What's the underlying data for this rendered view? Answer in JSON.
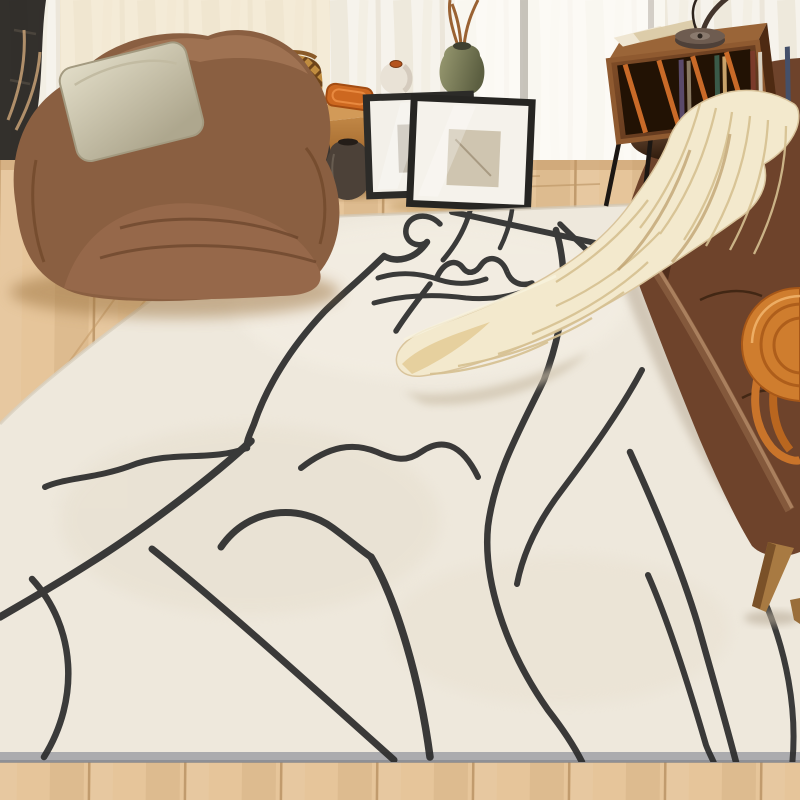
{
  "scene": {
    "kind": "living-room product photo",
    "description": "Bright living room with a large cream area rug decorated with black abstract one-line face art. A brown leather bean-bag armchair with a linen pillow sits at the left by sheer curtains, a wooden bench with baskets, vases and leaning picture frames lines the window, a walnut record cabinet with a black lamp stands beside a brown leather sofa on the right, and a chunky cream knit throw cascades from the sofa armrest onto the rug. An orange woven bag rests on the sofa seat.",
    "objects": [
      "sheer white curtains",
      "black plant stand",
      "light oak plank floor",
      "wooden window bench",
      "rattan lattice basket",
      "orange woven tray",
      "white speckled vase",
      "green ceramic vase with dried branches",
      "two black clay pots",
      "two leaning black picture frames",
      "cream abstract line-art area rug",
      "brown leather bean-bag chair",
      "beige linen pillow",
      "walnut record cabinet with vinyl records",
      "black desk lamp",
      "papers on cabinet",
      "brown leather sofa",
      "dark leather cushion",
      "cream chunky knit throw blanket",
      "orange woven handbag",
      "tapered wooden sofa legs"
    ]
  },
  "palette": {
    "curtain": "#f6f3ec",
    "curtain-fold": "#e6ddcb",
    "window-glow": "#fdfcf8",
    "warm-light": "#f3e4c6",
    "floor-light": "#e6c59a",
    "floor-dark": "#c2925c",
    "plank-gap": "#a87f4e",
    "rug-base": "#eee8dc",
    "rug-shade": "#e0d8c6",
    "rug-edge": "#a3a4a8",
    "line-color": "#2b2b2b",
    "chair-leather": "#8a5f41",
    "chair-leather-dark": "#5e3a22",
    "pillow-linen": "#d3cdb6",
    "bench-wood": "#c08746",
    "basket": "#c08c3f",
    "tray-orange": "#cd6820",
    "vase-white": "#e9e2d6",
    "vase-green": "#8f9066",
    "pot-dark": "#3b3530",
    "frame-border": "#2a2927",
    "frame-mat": "#f4f1ea",
    "cabinet-wood": "#74421f",
    "cabinet-side": "#4e2a12",
    "lamp-metal": "#4e4038",
    "sofa-leather": "#6e432b",
    "sofa-leather-dark": "#3f2413",
    "leg-wood": "#a87a42",
    "throw-cream": "#f3e9cd",
    "throw-shade": "#c3a877",
    "throw-gold": "#e2c78e",
    "bag-orange": "#cf7d2e",
    "bag-orange-dark": "#a5561a"
  },
  "rug": {
    "base_color": "#eee8dc",
    "edge_color": "#a3a4a8",
    "line_color": "#2b2b2b",
    "line_art_paths": [
      {
        "d": "M 440,224 C 428,211 408,215 406,229 C 404,242 418,249 427,242",
        "w": 5.5
      },
      {
        "d": "M 427,242 C 415,260 396,263 384,256 C 362,278 342,294 324,312 C 290,348 266,388 254,424 C 249,436 246,442 247,448",
        "w": 6.5
      },
      {
        "d": "M 247,448 C 210,462 170,450 130,466 C 98,478 64,478 45,487",
        "w": 6
      },
      {
        "d": "M 251,441 C 216,474 146,528 90,563 C 54,586 22,604 0,617",
        "w": 7.5
      },
      {
        "d": "M 152,549 C 214,598 306,681 394,760",
        "w": 7
      },
      {
        "d": "M 32,579 C 76,627 80,699 44,757",
        "w": 6.5
      },
      {
        "d": "M 221,547 C 249,506 301,504 333,528 C 352,542 362,551 371,557",
        "w": 7
      },
      {
        "d": "M 371,557 C 397,601 420,681 430,757",
        "w": 7.5
      },
      {
        "d": "M 301,468 C 329,446 353,442 377,452 C 395,460 407,462 421,452 C 441,438 461,442 478,477",
        "w": 6
      },
      {
        "d": "M 437,277 C 444,262 456,258 463,268 C 468,275 476,273 481,265 C 489,254 502,258 507,272 C 511,282 520,287 532,283",
        "w": 5.5
      },
      {
        "d": "M 378,278 C 400,271 420,273 440,280 C 456,285 472,284 486,279",
        "w": 5
      },
      {
        "d": "M 374,303 C 404,295 436,294 466,298 C 488,300 506,297 522,292",
        "w": 5
      },
      {
        "d": "M 430,284 C 418,300 406,315 396,331",
        "w": 5.5
      },
      {
        "d": "M 470,211 C 465,229 455,246 443,260",
        "w": 5
      },
      {
        "d": "M 512,210 C 510,224 506,236 500,248",
        "w": 4.5
      },
      {
        "d": "M 452,212 C 500,222 550,233 600,244 C 634,251 668,256 694,255",
        "w": 6
      },
      {
        "d": "M 560,224 C 573,237 586,249 598,261",
        "w": 5.5
      },
      {
        "d": "M 556,230 C 571,280 562,332 544,380 C 520,430 495,472 488,526 C 483,577 503,646 548,710 C 562,728 574,746 582,762",
        "w": 6.5
      },
      {
        "d": "M 642,370 C 622,408 592,450 562,490 C 542,516 524,548 517,584",
        "w": 6
      },
      {
        "d": "M 630,452 C 654,505 680,565 698,625 C 710,668 724,716 736,762",
        "w": 6.5
      },
      {
        "d": "M 648,575 C 670,625 690,690 706,745 C 709,753 712,758 714,763",
        "w": 6
      },
      {
        "d": "M 764,600 C 786,650 798,710 792,766",
        "w": 6
      }
    ]
  }
}
